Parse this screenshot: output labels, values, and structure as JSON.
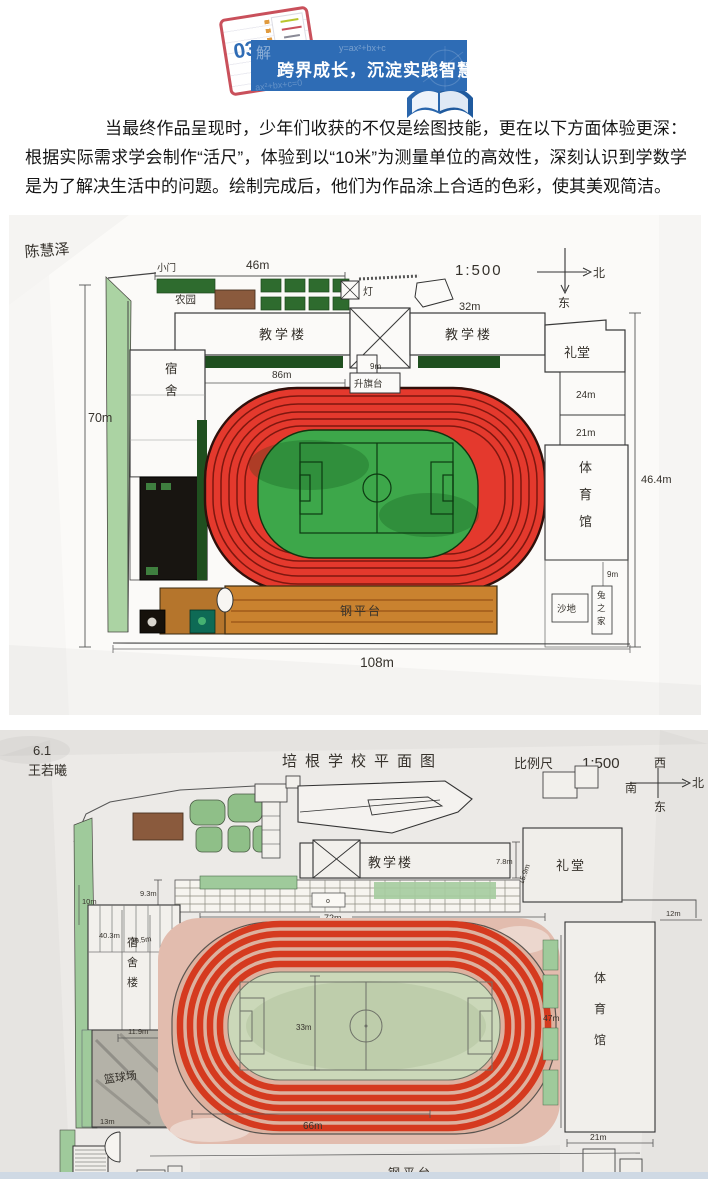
{
  "header": {
    "badge_number": "03",
    "badge_glyph": "解",
    "banner_title": "跨界成长，沉淀实践智慧",
    "formula_top": "y=ax²+bx+c",
    "formula_bottom": "ax²+bx+c=0",
    "colors": {
      "banner_blue": "#2e6cb5",
      "notebook_red": "#c9505b"
    }
  },
  "paragraph": "当最终作品呈现时，少年们收获的不仅是绘图技能，更在以下方面体验更深：根据实际需求学会制作“活尺”，体验到以“10米”为测量单位的高效性，深刻认识到学数学是为了解决生活中的问题。绘制完成后，他们为作品涂上合适的色彩，使其美观简洁。",
  "drawing1": {
    "author": "陈慧泽",
    "scale": "1:500",
    "compass_north": "北",
    "compass_east": "东",
    "labels": {
      "gate": "小门",
      "farm": "农园",
      "teach_left": "教学楼",
      "teach_right": "教学楼",
      "lamp": "灯",
      "auditorium": "礼堂",
      "flag": "升旗台",
      "dorm": "宿舍",
      "gym": "体育馆",
      "sand": "沙地",
      "rabbit": "兔之家",
      "platform": "钢平台"
    },
    "measurements": {
      "m46": "46m",
      "m32": "32m",
      "m70": "70m",
      "m45_6": "45.6m",
      "m86": "86m",
      "m9a": "9m",
      "m24": "24m",
      "m21": "21m",
      "m46_4": "46.4m",
      "m9b": "9m",
      "m108": "108m"
    }
  },
  "drawing2": {
    "class_no": "6.1",
    "author": "王若曦",
    "title": "培根学校平面图",
    "scale_label": "比例尺",
    "scale_value": "1:500",
    "compass_west": "西",
    "compass_north": "北",
    "compass_south": "南",
    "compass_east": "东",
    "labels": {
      "teach": "教学楼",
      "auditorium": "礼堂",
      "dorm": "宿舍楼",
      "basketball": "篮球场",
      "gym": "体育馆",
      "platform": "钢平台",
      "bench_mark": "o"
    },
    "measurements": {
      "m7_8": "7.8m",
      "m15_9": "15.9m",
      "m22": "22m",
      "m12": "12m",
      "m72": "72m",
      "m9_3": "9.3m",
      "m10a": "10m",
      "m40_3": "40.3m",
      "m29_5": "29.5m",
      "m11_9": "11.9m",
      "m10b": "10m",
      "m13": "13m",
      "m33": "33m",
      "m66": "66m",
      "m47": "47m",
      "m21": "21m"
    }
  }
}
